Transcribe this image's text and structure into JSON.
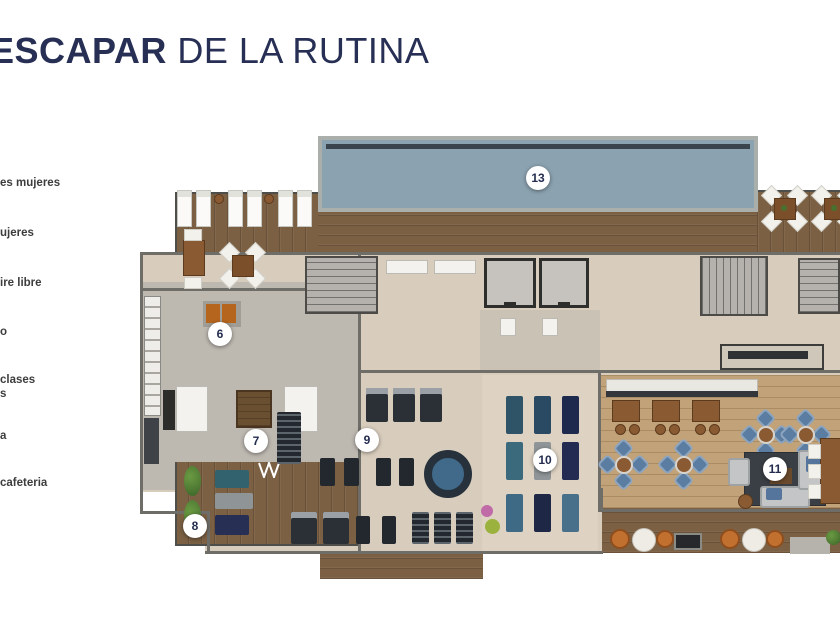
{
  "title": {
    "bold": "ESCAPAR",
    "light": " DE LA RUTINA"
  },
  "legend": {
    "items": [
      {
        "text": "es mujeres",
        "y": 177
      },
      {
        "text": "ujeres",
        "y": 227
      },
      {
        "text": "ire libre",
        "y": 277
      },
      {
        "text": "o",
        "y": 326
      },
      {
        "text": "clases",
        "y": 374
      },
      {
        "text": "s",
        "y": 388
      },
      {
        "text": "a",
        "y": 430
      },
      {
        "text": "cafeteria",
        "y": 477
      }
    ]
  },
  "markers": [
    {
      "label": "13",
      "x": 538,
      "y": 178
    },
    {
      "label": "6",
      "x": 220,
      "y": 334
    },
    {
      "label": "7",
      "x": 256,
      "y": 441
    },
    {
      "label": "8",
      "x": 195,
      "y": 526
    },
    {
      "label": "9",
      "x": 367,
      "y": 440
    },
    {
      "label": "10",
      "x": 545,
      "y": 460
    },
    {
      "label": "11",
      "x": 775,
      "y": 469
    }
  ],
  "colors": {
    "title": "#272f55",
    "legend_text": "#3d3d3d",
    "marker_text": "#232c4e",
    "pool": "#8ba2b0",
    "deck_wood": "#7b6043",
    "floor": "#d8cdbd"
  }
}
